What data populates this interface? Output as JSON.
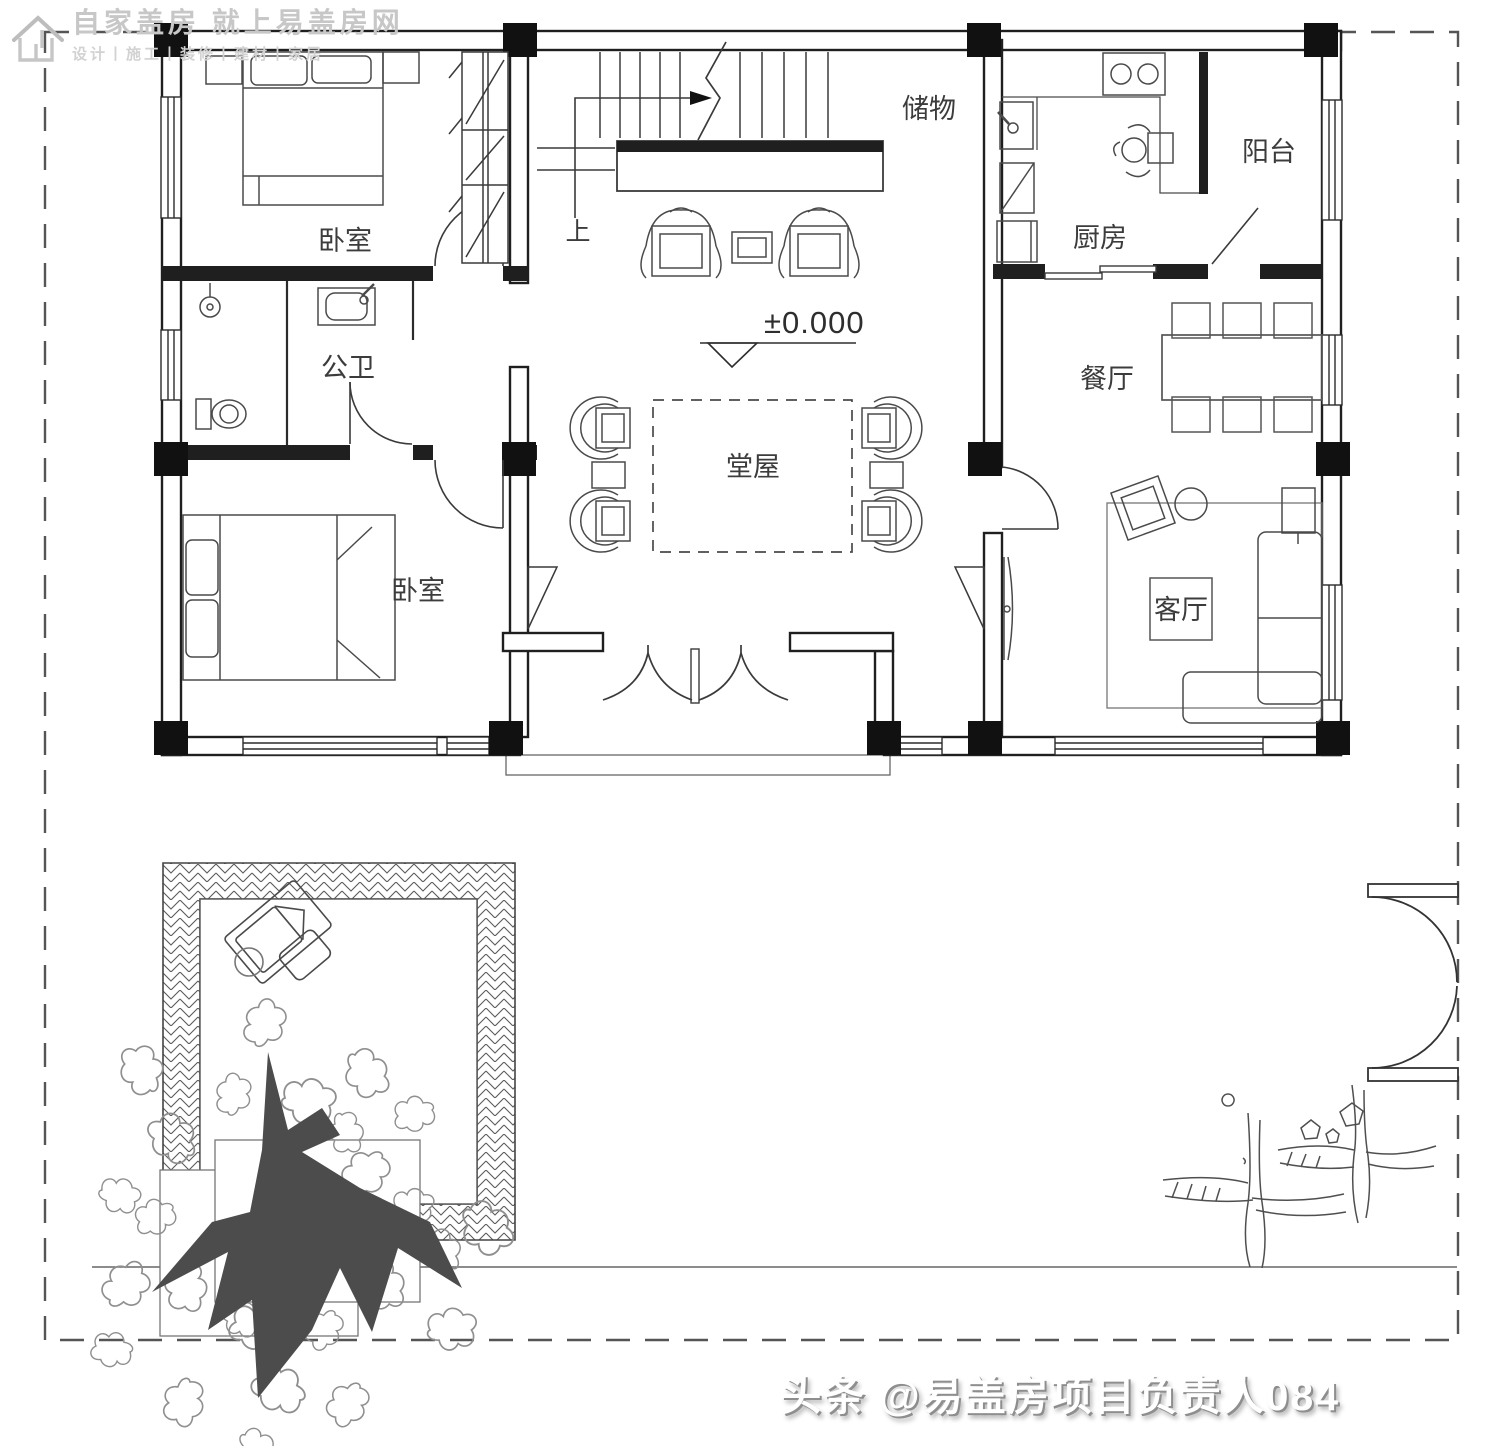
{
  "watermark": {
    "logo_icon": "house-logo-icon",
    "title": "自家盖房 就上易盖房网",
    "subtitle": "设计丨施工丨装修丨建材丨家居"
  },
  "attribution": {
    "handle": "头条 @易盖房项目负责人084"
  },
  "plan": {
    "type": "floor-plan",
    "elevation_label": "±0.000",
    "stair_direction_label": "上",
    "rooms": [
      {
        "id": "bedroom-top",
        "label": "卧室"
      },
      {
        "id": "bathroom",
        "label": "公卫"
      },
      {
        "id": "bedroom-bottom",
        "label": "卧室"
      },
      {
        "id": "hall",
        "label": "堂屋"
      },
      {
        "id": "storage",
        "label": "储物"
      },
      {
        "id": "kitchen",
        "label": "厨房"
      },
      {
        "id": "balcony",
        "label": "阳台"
      },
      {
        "id": "dining",
        "label": "餐厅"
      },
      {
        "id": "living",
        "label": "客厅"
      }
    ]
  },
  "colors": {
    "wall_line": "#1f1f1f",
    "furniture_line": "#4a4a4a",
    "light_line": "#8a8a8a",
    "watermark_gray": "#c7c7c7",
    "attribution_shadow": "#8e8e8e",
    "tree_trunk": "#4c4c4c",
    "foliage": "#8f8f8f",
    "hatch": "#5a5a5a"
  }
}
